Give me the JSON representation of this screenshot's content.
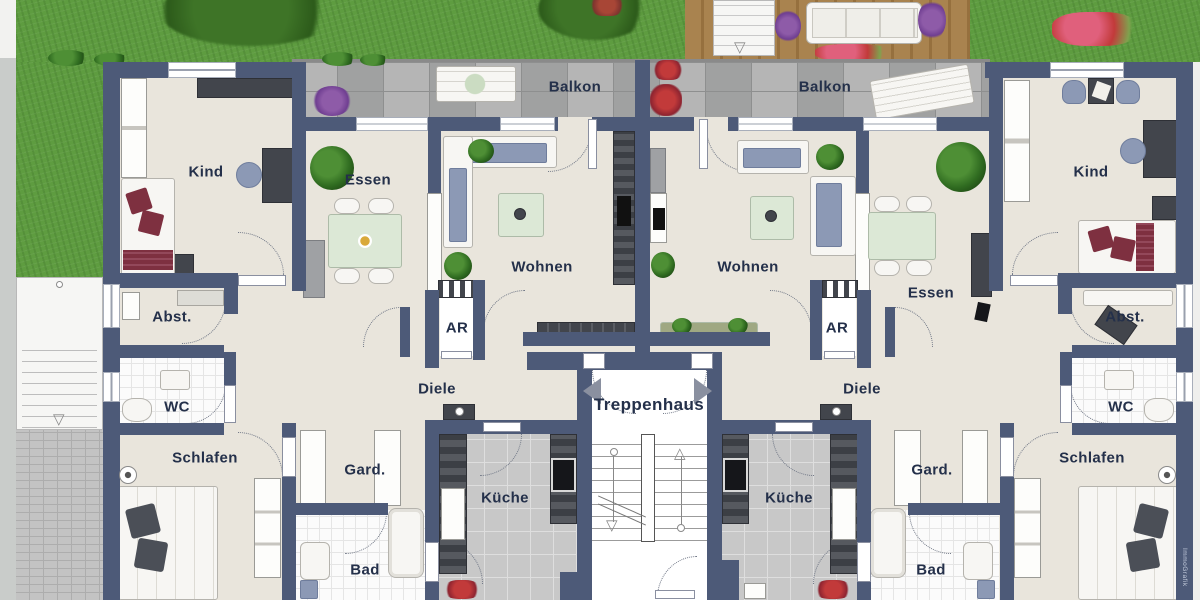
{
  "labels": {
    "balkon_left": "Balkon",
    "balkon_right": "Balkon",
    "kind_left": "Kind",
    "kind_right": "Kind",
    "essen_left": "Essen",
    "essen_right": "Essen",
    "wohnen_left": "Wohnen",
    "wohnen_right": "Wohnen",
    "abst_left": "Abst.",
    "abst_right": "Abst.",
    "ar_left": "AR",
    "ar_right": "AR",
    "diele_left": "Diele",
    "diele_right": "Diele",
    "treppenhaus": "Treppenhaus",
    "wc_left": "WC",
    "wc_right": "WC",
    "schlafen_left": "Schlafen",
    "schlafen_right": "Schlafen",
    "gard_left": "Gard.",
    "gard_right": "Gard.",
    "kueche_left": "Küche",
    "kueche_right": "Küche",
    "bad_left": "Bad",
    "bad_right": "Bad"
  },
  "stairs": {
    "up_arrow": "△",
    "down_arrow": "▽"
  },
  "watermark": "ImmoGrafik",
  "colors": {
    "wall": "#4D5A78",
    "floor": "#E9E5DC",
    "label": "#24304A",
    "grass": "#5E9C40",
    "deck": "#A9834F",
    "balcony_tile": "#ABABAB",
    "sofa_blue": "#8C99B5",
    "maroon": "#7E3040",
    "table_green": "#DCE8D6"
  }
}
